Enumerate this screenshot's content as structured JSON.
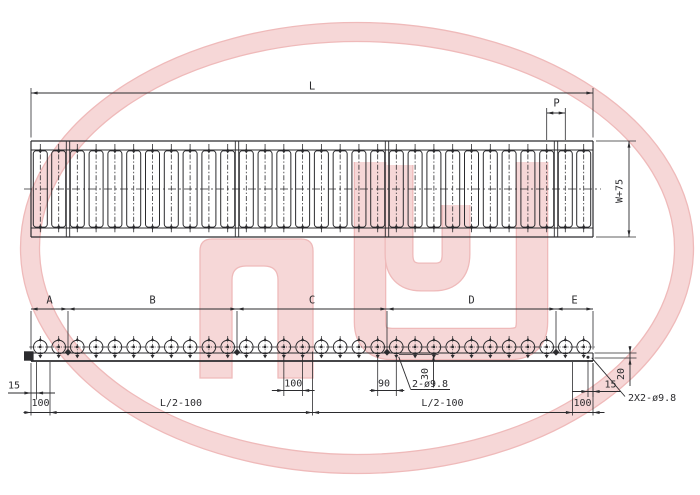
{
  "drawing": {
    "background": "#ffffff",
    "line_color": "#2b2b2e",
    "watermark": {
      "letters": "HQ",
      "fill": "#f6d7d7",
      "edge": "#efbaba"
    },
    "top_view": {
      "length_label": "L",
      "pitch_label": "P",
      "width_label": "W+75",
      "roller_count": 30,
      "section_joint_count": 4
    },
    "side_view": {
      "section_labels": [
        "A",
        "B",
        "C",
        "D",
        "E"
      ],
      "roller_count": 30,
      "dim_labels": {
        "left_end_to_hole": "15",
        "left_hole_pitch": "100",
        "left_half_length": "L/2-100",
        "mid_roller_pitch": "100",
        "joint_roller_pitch": "90",
        "joint_hole_offset": "30",
        "joint_holes_note": "2-ø9.8",
        "right_half_length": "L/2-100",
        "right_end_to_hole": "15",
        "end_hole_depth": "20",
        "end_holes_note": "2X2-ø9.8",
        "right_hole_pitch": "100"
      }
    }
  }
}
